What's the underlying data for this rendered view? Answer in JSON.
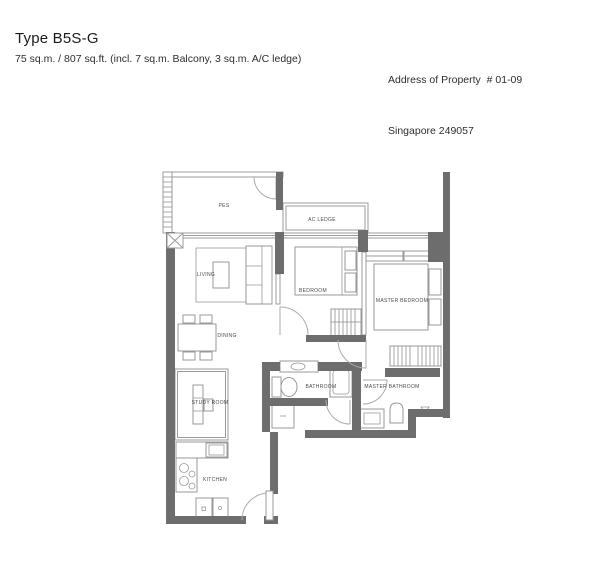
{
  "header": {
    "title": "Type B5S-G",
    "subtitle": "75 sq.m. / 807 sq.ft. (incl. 7 sq.m. Balcony, 3 sq.m. A/C ledge)",
    "address_line1": "Address of Property  # 01-09",
    "address_line2": "Singapore 249057"
  },
  "floorplan": {
    "unit_type": "B5S-G",
    "rooms": {
      "pes": "PES",
      "ac_ledge": "AC LEDGE",
      "living": "LIVING",
      "dining": "DINING",
      "bedroom": "BEDROOM",
      "master_bedroom": "MASTER BEDROOM",
      "study": "STUDY ROOM",
      "bathroom": "BATHROOM",
      "master_bathroom": "MASTER BATHROOM",
      "kitchen": "KITCHEN"
    },
    "colors": {
      "wall": "#6d6d6d",
      "thin_line": "#9b9b9b",
      "label": "#4a4a4a"
    }
  }
}
